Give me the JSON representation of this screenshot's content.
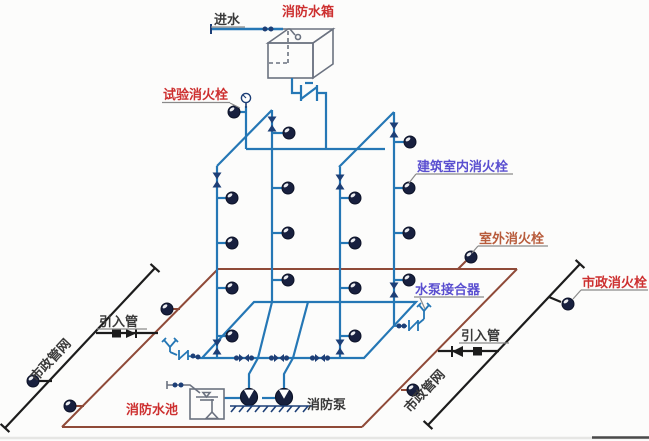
{
  "diagram": {
    "type": "fire-protection-water-supply-system-schematic",
    "labels": {
      "inlet_water": "进水",
      "fire_water_tank": "消防水箱",
      "test_fire_hydrant": "试验消火栓",
      "indoor_fire_hydrant": "建筑室内消火栓",
      "outdoor_fire_hydrant": "室外消火栓",
      "pump_adapter": "水泵接合器",
      "municipal_fire_hydrant": "市政消火栓",
      "inlet_pipe_left": "引入管",
      "inlet_pipe_right": "引入管",
      "municipal_network_left": "市政管网",
      "municipal_network_right": "市政管网",
      "fire_pool": "消防水池",
      "fire_pump": "消防泵"
    },
    "colors": {
      "indoor_pipe_blue": "#2577b5",
      "outdoor_ring_brown": "#8f4a38",
      "municipal_line_black": "#1c1c1c",
      "equipment_gray": "#6b7280",
      "symbol_navy": "#1d3f77",
      "hydrant_dark": "#18203f",
      "label_red": "#cd3030",
      "label_indigo": "#5a4fd0",
      "label_orange": "#b85c3c",
      "label_dark": "#3a3a3a"
    }
  }
}
